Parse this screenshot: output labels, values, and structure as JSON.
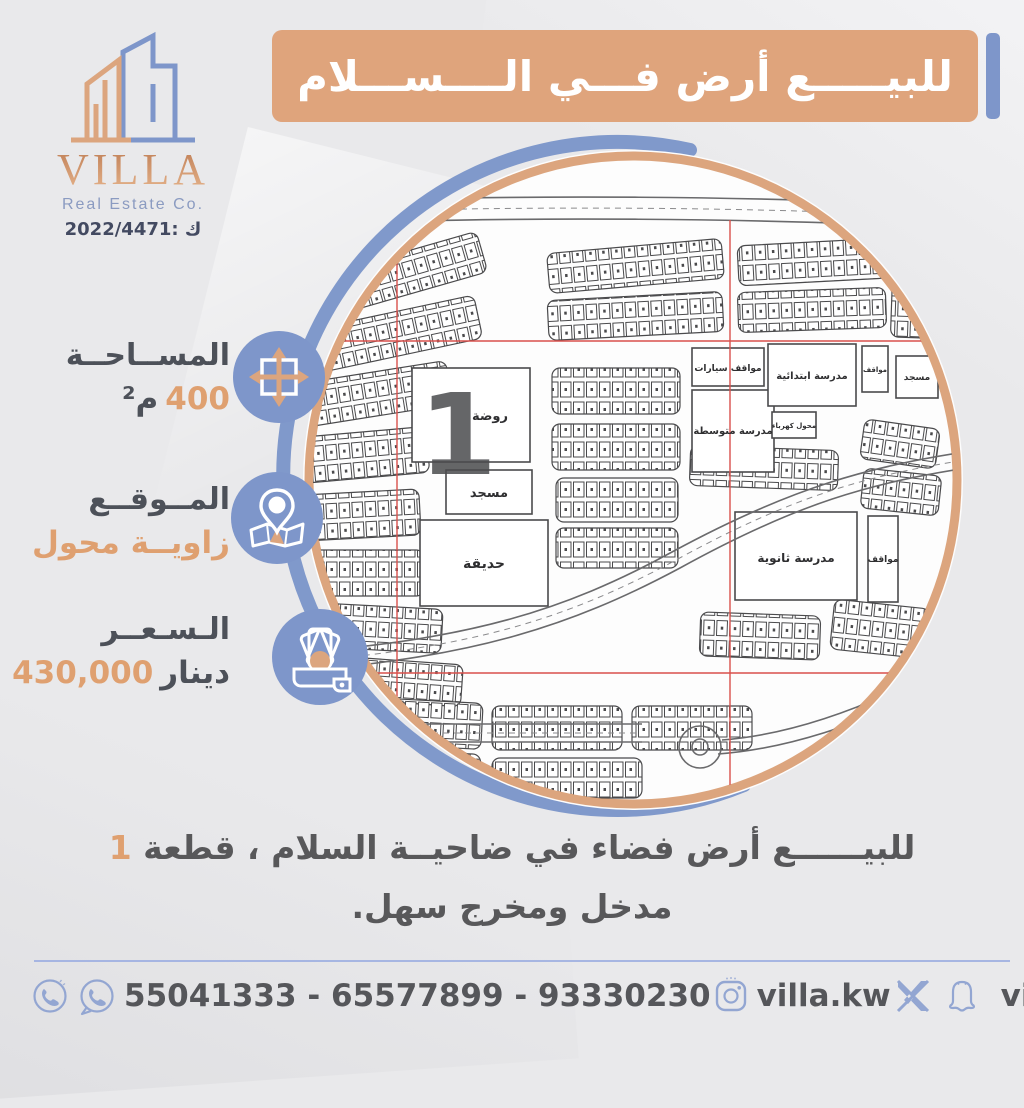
{
  "colors": {
    "accent_orange": "#DFA47C",
    "accent_blue": "#7E96CA",
    "text_dark": "#55565A",
    "navy": "#434A61",
    "survey_red": "#D9504C",
    "map_ink": "#4A4A4C"
  },
  "logo": {
    "name": "VILLA",
    "subtitle": "Real Estate Co.",
    "license": "ك :2022/4471"
  },
  "banner": {
    "title": "للبيـــــع أرض فـــي الــــســـلام"
  },
  "info": {
    "items": [
      {
        "label": "المســاحــة",
        "value": "400",
        "unit": "م²",
        "icon": "area-expand-icon"
      },
      {
        "label": "المــوقــع",
        "value": "زاويــة محول",
        "unit": "",
        "icon": "location-pin-icon"
      },
      {
        "label": "الـسـعــر",
        "value": "430,000",
        "unit": "دينار",
        "icon": "money-wallet-icon"
      }
    ]
  },
  "map": {
    "plot_number": "1",
    "labels": {
      "kindergarten": "روضة",
      "mosque": "مسجد",
      "park": "حديقة",
      "car_parking": "مواقف سيارات",
      "middle_school": "مدرسة متوسطة",
      "primary_school": "مدرسة ابتدائية",
      "transformer": "محول كهرباء",
      "secondary_school": "مدرسة ثانوية",
      "parking": "مواقف",
      "small_mosque": "مسجد"
    }
  },
  "description": {
    "line1": "للبيــــــع أرض فضاء في ضاحيــة السلام ، قطعة ",
    "highlight": "1",
    "line2": "مدخل ومخرج سهل."
  },
  "footer": {
    "phones": "55041333 - 65577899 - 93330230",
    "instagram": "villa.kw",
    "handle": "villa_kw"
  }
}
